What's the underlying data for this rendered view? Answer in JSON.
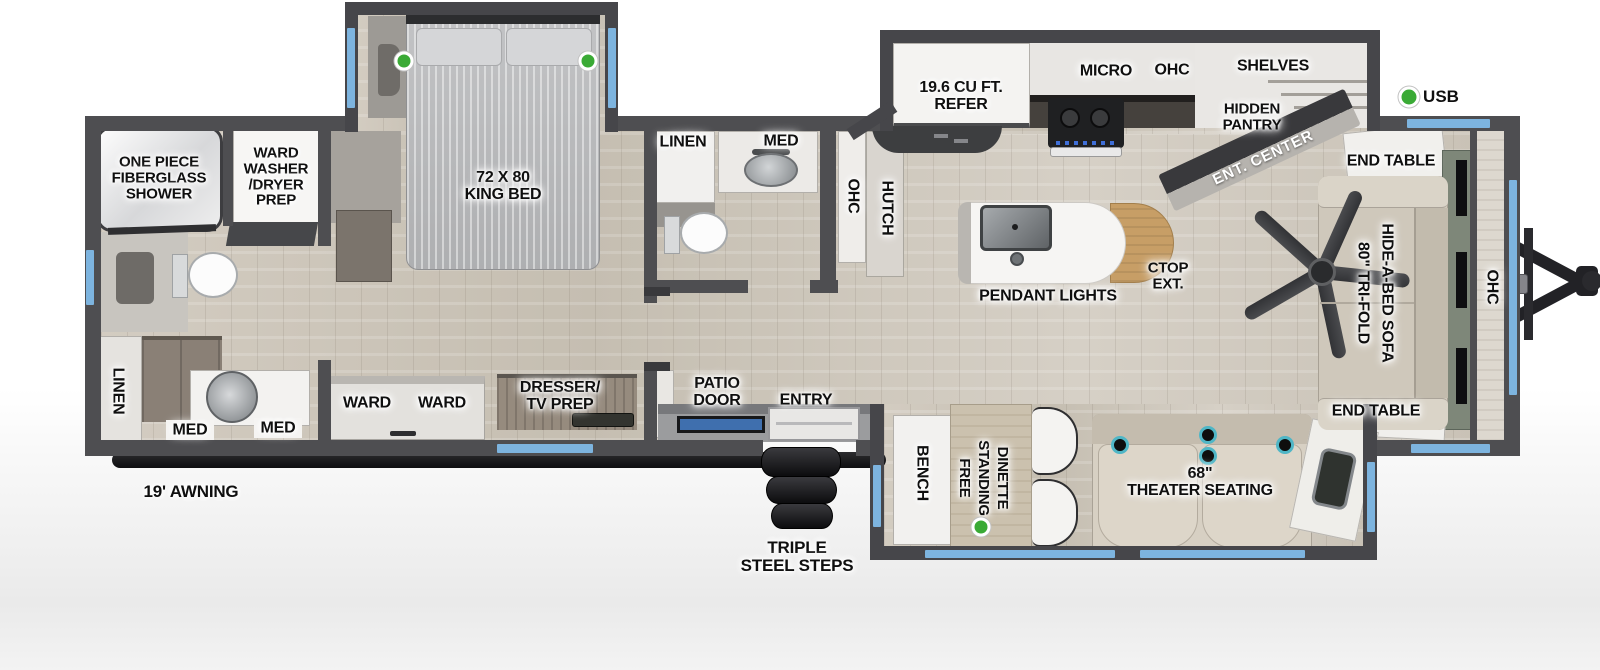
{
  "legend": {
    "usb": "USB"
  },
  "exterior": {
    "awning": "19' AWNING",
    "steps": "TRIPLE\nSTEEL STEPS"
  },
  "rear_bath": {
    "shower": "ONE PIECE\nFIBERGLASS\nSHOWER",
    "ward_washer": "WARD\nWASHER\n/DRYER\nPREP",
    "linen": "LINEN",
    "med1": "MED",
    "med2": "MED"
  },
  "bedroom": {
    "king_bed": "72 X 80\nKING BED",
    "ward1": "WARD",
    "ward2": "WARD",
    "dresser": "DRESSER/\nTV PREP"
  },
  "mid_bath": {
    "linen": "LINEN",
    "med": "MED",
    "ohc": "OHC"
  },
  "kitchen": {
    "hutch": "HUTCH",
    "refer": "19.6 CU FT.\nREFER",
    "micro": "MICRO",
    "ohc": "OHC",
    "shelves": "SHELVES",
    "hidden_pantry": "HIDDEN\nPANTRY",
    "ent_center": "ENT. CENTER",
    "pendant_lights": "PENDANT LIGHTS",
    "ctop_ext": "CTOP\nEXT."
  },
  "living": {
    "end_table_top": "END TABLE",
    "end_table_bottom": "END TABLE",
    "sofa_line1": "80\" TRI-FOLD",
    "sofa_line2": "HIDE-A-BED SOFA",
    "ohc": "OHC"
  },
  "entry": {
    "patio_door": "PATIO\nDOOR",
    "entry": "ENTRY"
  },
  "dinette": {
    "bench": "BENCH",
    "word1": "FREE",
    "word2": "STANDING",
    "word3": "DINETTE",
    "theater": "68\"\nTHEATER SEATING"
  },
  "colors": {
    "wall": "#4e4e51",
    "window": "#7db4df",
    "usb_green": "#3aaa35",
    "cupholder_ring": "#4fb6c6",
    "floor": "#cbc4b8",
    "patio_door": "#3f6fae",
    "awning": "#141416"
  }
}
